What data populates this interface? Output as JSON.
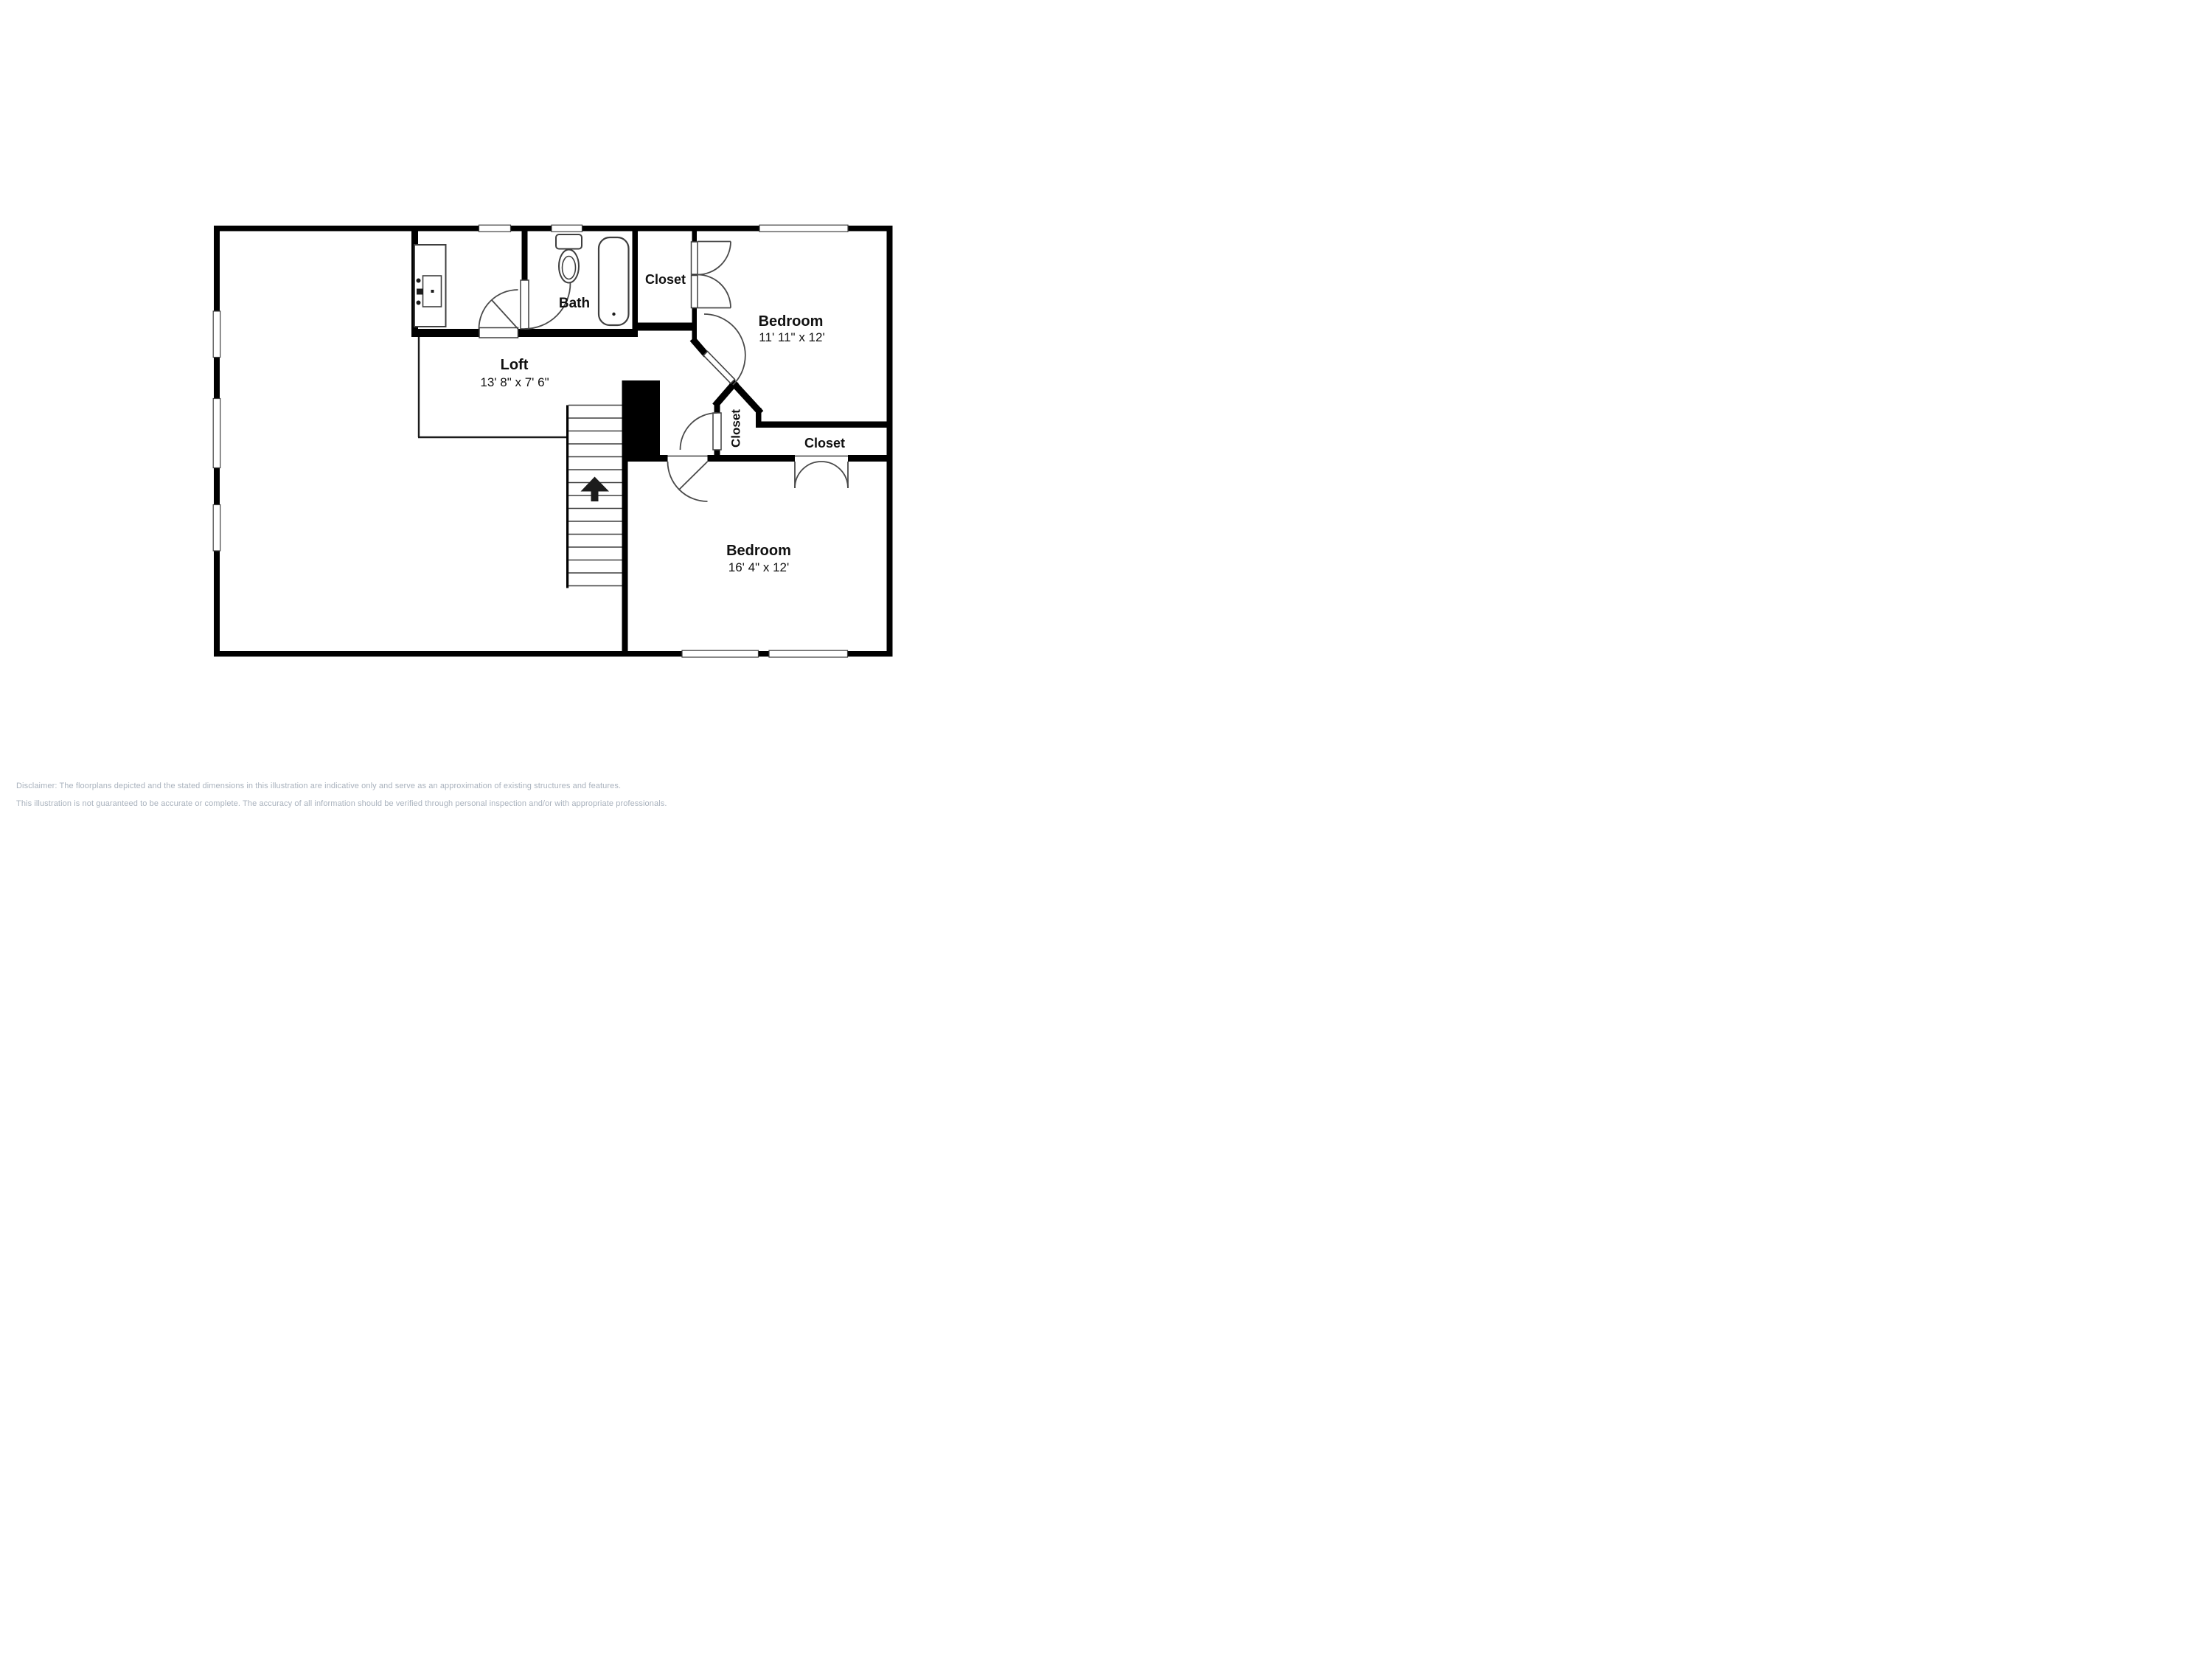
{
  "floorplan": {
    "title": "Second floor plan",
    "rooms": [
      {
        "id": "loft",
        "label": "Loft",
        "dims": "13' 8\" x 7' 6\""
      },
      {
        "id": "bath",
        "label": "Bath",
        "dims": ""
      },
      {
        "id": "closet_top",
        "label": "Closet",
        "dims": ""
      },
      {
        "id": "bedroom_top",
        "label": "Bedroom",
        "dims": "11' 11\" x 12'"
      },
      {
        "id": "closet_angled",
        "label": "Closet",
        "dims": ""
      },
      {
        "id": "closet_right",
        "label": "Closet",
        "dims": ""
      },
      {
        "id": "bedroom_bottom",
        "label": "Bedroom",
        "dims": "16' 4\" x 12'"
      }
    ],
    "fixtures": [
      "sink-vanity",
      "toilet",
      "bathtub",
      "stairs-up-arrow"
    ],
    "stairs": {
      "treads": 14,
      "direction": "up"
    },
    "colors": {
      "wall": "#000000",
      "thin_line": "#3f3f3f",
      "background": "#ffffff",
      "text": "#111111",
      "disclaimer_text": "#a9b2bd"
    }
  },
  "disclaimer": {
    "line1": "Disclaimer: The floorplans depicted and the stated dimensions in this illustration are indicative only and serve as an approximation of existing structures and features.",
    "line2": "This illustration is not guaranteed to be accurate or complete. The accuracy of all information should be verified through personal inspection and/or with appropriate professionals."
  }
}
